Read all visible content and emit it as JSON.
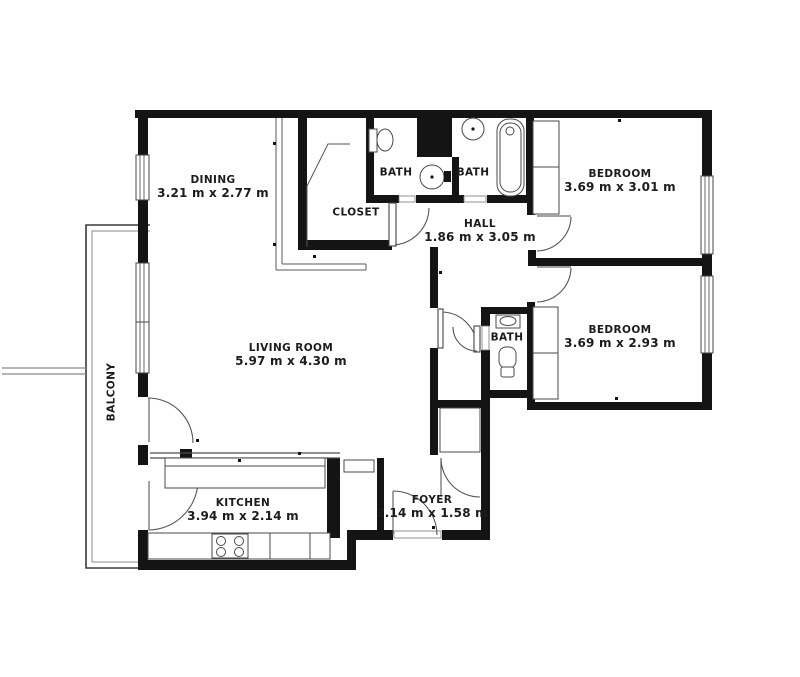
{
  "plan": {
    "type": "apartment-floor-plan",
    "background": "#ffffff",
    "wall_color": "#141414",
    "line_color": "#555555",
    "text_color": "#1c1c1c",
    "rooms": [
      {
        "id": "dining",
        "name": "DINING",
        "dims": "3.21 m x 2.77 m"
      },
      {
        "id": "closet",
        "name": "CLOSET",
        "dims": ""
      },
      {
        "id": "bath-1",
        "name": "BATH",
        "dims": ""
      },
      {
        "id": "bath-2",
        "name": "BATH",
        "dims": ""
      },
      {
        "id": "hall",
        "name": "HALL",
        "dims": "1.86 m x 3.05 m"
      },
      {
        "id": "bedroom-1",
        "name": "BEDROOM",
        "dims": "3.69 m x 3.01 m"
      },
      {
        "id": "bedroom-2",
        "name": "BEDROOM",
        "dims": "3.69 m x 2.93 m"
      },
      {
        "id": "living",
        "name": "LIVING ROOM",
        "dims": "5.97 m x 4.30 m"
      },
      {
        "id": "bath-3",
        "name": "BATH",
        "dims": ""
      },
      {
        "id": "kitchen",
        "name": "KITCHEN",
        "dims": "3.94 m x 2.14 m"
      },
      {
        "id": "foyer",
        "name": "FOYER",
        "dims": "2.14 m x 1.58 m"
      },
      {
        "id": "balcony",
        "name": "BALCONY",
        "dims": ""
      }
    ]
  }
}
